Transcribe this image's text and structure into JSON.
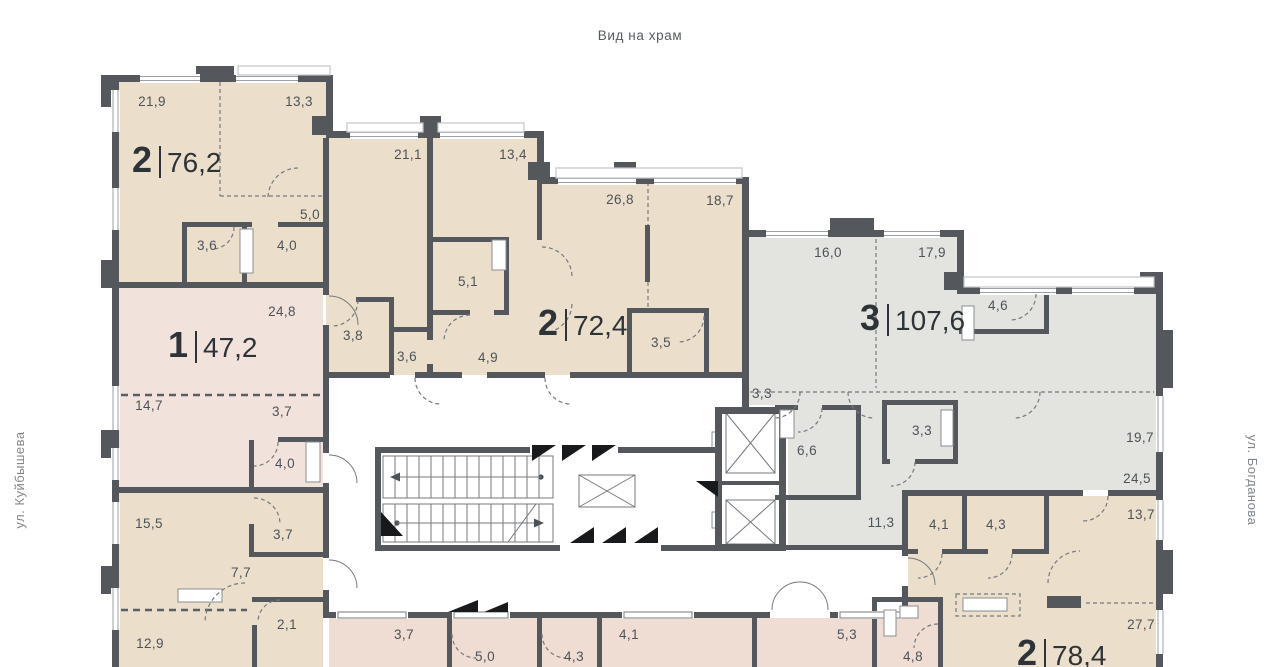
{
  "title": "Вид на храм",
  "streets": {
    "left": "ул. Куйбышева",
    "right": "ул. Богданова"
  },
  "colors": {
    "wall": "#54585c",
    "apartment_beige": "#ebdfcc",
    "apartment_pink": "#f1e3dc",
    "apartment_pink_bottom": "#efdcd2",
    "apartment_gray": "#e3e4e0",
    "text": "#4d5257"
  },
  "apartments": {
    "a76": {
      "unit": "2",
      "area": "76,2",
      "rooms": [
        "21,9",
        "13,3",
        "21,1",
        "5,0",
        "3,6",
        "4,0",
        "3,8",
        "3,6"
      ]
    },
    "a72": {
      "unit": "2",
      "area": "72,4",
      "rooms": [
        "13,4",
        "26,8",
        "18,7",
        "5,1",
        "4,9",
        "3,5"
      ]
    },
    "a107": {
      "unit": "3",
      "area": "107,6",
      "rooms": [
        "16,0",
        "17,9",
        "4,6",
        "19,7",
        "24,5",
        "3,3",
        "6,6",
        "3,3",
        "11,3"
      ]
    },
    "a47": {
      "unit": "1",
      "area": "47,2",
      "rooms": [
        "24,8",
        "14,7",
        "3,7",
        "4,0"
      ]
    },
    "left_bottom": {
      "rooms": [
        "15,5",
        "3,7",
        "7,7",
        "2,1",
        "12,9"
      ]
    },
    "middle_bottom": {
      "rooms": [
        "3,7",
        "5,0",
        "4,3",
        "4,1",
        "5,3",
        "4,8"
      ]
    },
    "a78": {
      "unit": "2",
      "area": "78,4",
      "rooms": [
        "4,1",
        "4,3",
        "13,7",
        "27,7"
      ]
    }
  }
}
